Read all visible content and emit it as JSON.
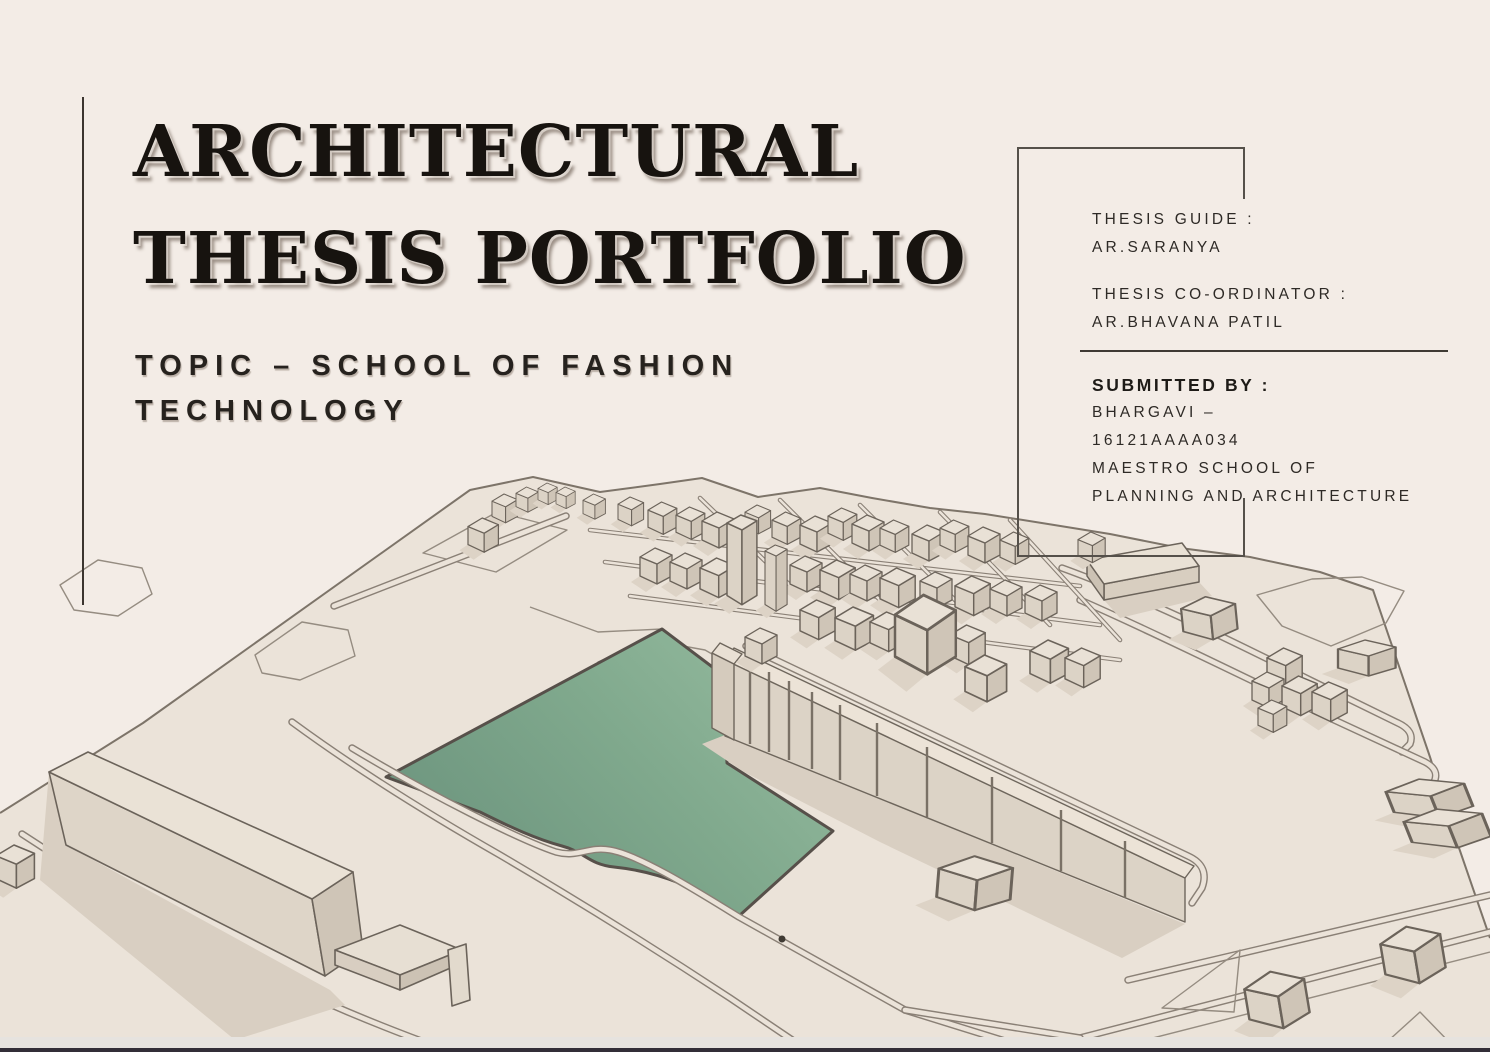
{
  "document_type": "architectural thesis portfolio cover slide",
  "title": {
    "line1": "ARCHITECTURAL",
    "line2": "THESIS PORTFOLIO"
  },
  "topic": {
    "line1": "TOPIC – SCHOOL OF FASHION",
    "line2": "TECHNOLOGY"
  },
  "credits": {
    "thesis_guide_label": "THESIS GUIDE :",
    "thesis_guide_name": "AR.SARANYA",
    "coordinator_label": "THESIS CO-ORDINATOR :",
    "coordinator_name": "AR.BHAVANA PATIL",
    "submitted_by_label": "SUBMITTED BY :",
    "submitted_by_name": "BHARGAVI –",
    "submitted_by_id": "16121AAAA034",
    "school_line1": "MAESTRO SCHOOL OF",
    "school_line2": "PLANNING AND ARCHITECTURE"
  },
  "illustration": {
    "name": "3d-site-model",
    "description": "Axonometric 3D site model of a neighbourhood with roads, building blocks and a highlighted site plot in green",
    "site_plot_color_dark": "#6b937d",
    "site_plot_color_light": "#95bb9f",
    "ground_color": "#ebe3d9",
    "outline_color": "#8a8076",
    "shadow_color": "#d9cfc2"
  },
  "colors": {
    "background": "#f3ece6",
    "text": "#2e2a26",
    "bottom_bar_dark": "#322e38",
    "bottom_bar_light": "#e6e3df"
  }
}
